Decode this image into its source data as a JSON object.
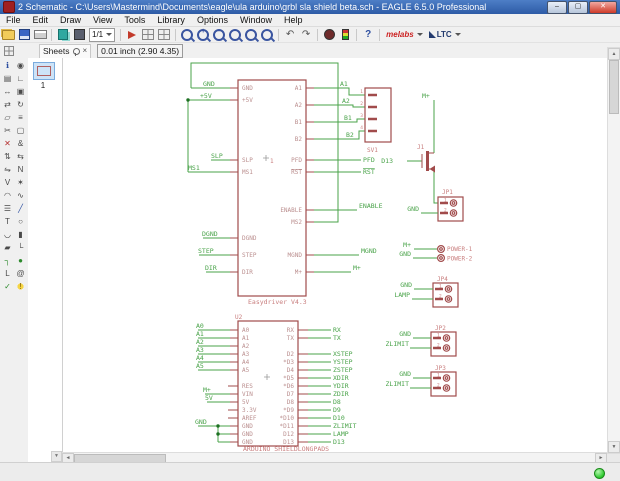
{
  "window": {
    "title": "2 Schematic - C:\\Users\\Mastermind\\Documents\\eagle\\ula arduino\\grbl sla shield beta.sch - EAGLE 6.5.0 Professional"
  },
  "menu": {
    "items": [
      "File",
      "Edit",
      "Draw",
      "View",
      "Tools",
      "Library",
      "Options",
      "Window",
      "Help"
    ]
  },
  "toolbar": {
    "sheet_selector": "1/1",
    "vendor_melabs": "melabs",
    "vendor_ltc": "LTC"
  },
  "param_bar": {
    "sheets_tab": "Sheets",
    "coordinates": "0.01 inch (2.90 4.35)"
  },
  "sheets_panel": {
    "sheet_label": "1"
  },
  "icons": {
    "minimize": "–",
    "maximize": "▢",
    "close": "✕",
    "help": "?",
    "undo": "↶",
    "redo": "↷",
    "zoom_fit": "◻",
    "zoom_in": "+",
    "zoom_out": "–",
    "zoom_redraw": "↻",
    "zoom_select": "▭",
    "zoom_last": "«",
    "tools": {
      "info": "ℹ",
      "show": "◉",
      "display": "▤",
      "mark": "∟",
      "move": "↔",
      "copy": "▣",
      "mirror": "⇄",
      "rotate": "↻",
      "group": "▱",
      "change": "≡",
      "cut": "✂",
      "paste": "▢",
      "delete": "✕",
      "add": "&",
      "pinswap": "⇅",
      "replace": "⇆",
      "gateswap": "⇋",
      "name": "N",
      "value": "V",
      "smash": "✶",
      "miter": "◠",
      "split": "∿",
      "invoke": "☰",
      "wire": "╱",
      "text": "T",
      "circle": "○",
      "arc": "◡",
      "rect": "▮",
      "polygon": "▰",
      "bus": "└",
      "net": "┐",
      "junction": "●",
      "label": "L",
      "attribute": "@",
      "erc": "✓",
      "errors": "!"
    }
  },
  "schematic": {
    "easydriver": {
      "marker": "1",
      "value": "Easydriver V4.3",
      "pins_left": [
        {
          "pin": "GND",
          "net": "GND"
        },
        {
          "pin": "+5V",
          "net": "+5V"
        },
        {
          "pin": "SLP",
          "net": "SLP"
        },
        {
          "pin": "MS1",
          "net": "MS1"
        },
        {
          "pin": "DGND",
          "net": "DGND"
        },
        {
          "pin": "STEP",
          "net": "STEP"
        },
        {
          "pin": "DIR",
          "net": "DIR"
        }
      ],
      "pins_right": [
        {
          "pin": "A1",
          "net": "A1"
        },
        {
          "pin": "A2",
          "net": "A2"
        },
        {
          "pin": "B1",
          "net": "B1"
        },
        {
          "pin": "B2",
          "net": "B2"
        },
        {
          "pin": "PFD",
          "net": "PFD"
        },
        {
          "pin": "RST",
          "net": "RST"
        },
        {
          "pin": "ENABLE",
          "net": "ENABLE"
        },
        {
          "pin": "MS2",
          "net": ""
        },
        {
          "pin": "MGND",
          "net": "MGND"
        },
        {
          "pin": "M+",
          "net": "M+"
        }
      ]
    },
    "sv1": {
      "ref": "SV1",
      "pin_numbers": [
        "1",
        "2",
        "3",
        "4"
      ]
    },
    "mosfet": {
      "ref": "J1",
      "gate_net": "D13",
      "top_net": "M+"
    },
    "jp1": {
      "ref": "JP1",
      "net": "GND",
      "pin_numbers": [
        "1",
        "2"
      ]
    },
    "power": {
      "pin_labels": [
        "POWER-1",
        "POWER-2"
      ],
      "nets": [
        "M+",
        "GND"
      ]
    },
    "jp4": {
      "ref": "JP4",
      "nets": [
        "GND",
        "LAMP"
      ],
      "pin_numbers": [
        "1",
        "2"
      ]
    },
    "jp2": {
      "ref": "JP2",
      "nets": [
        "GND",
        "ZLIMIT"
      ],
      "pin_numbers": [
        "1",
        "2"
      ]
    },
    "jp3": {
      "ref": "JP3",
      "nets": [
        "GND",
        "ZLIMIT"
      ],
      "pin_numbers": [
        "1",
        "2"
      ]
    },
    "arduino": {
      "ref": "U2",
      "value": "ARDUINO_SHIELDLONGPADS",
      "pins_left": [
        {
          "pin": "A0",
          "net": "A0"
        },
        {
          "pin": "A1",
          "net": "A1"
        },
        {
          "pin": "A2",
          "net": "A2"
        },
        {
          "pin": "A3",
          "net": "A3"
        },
        {
          "pin": "A4",
          "net": "A4"
        },
        {
          "pin": "A5",
          "net": "A5"
        },
        {
          "pin": "RES",
          "net": ""
        },
        {
          "pin": "VIN",
          "net": "M+"
        },
        {
          "pin": "5V",
          "net": "5V"
        },
        {
          "pin": "3.3V",
          "net": ""
        },
        {
          "pin": "AREF",
          "net": ""
        },
        {
          "pin": "GND",
          "net": "GND"
        },
        {
          "pin": "GND",
          "net": ""
        },
        {
          "pin": "GND",
          "net": ""
        }
      ],
      "pins_right": [
        {
          "pin": "RX",
          "net": "RX"
        },
        {
          "pin": "TX",
          "net": "TX"
        },
        {
          "pin": "D2",
          "net": "XSTEP"
        },
        {
          "pin": "*D3",
          "net": "YSTEP"
        },
        {
          "pin": "D4",
          "net": "ZSTEP"
        },
        {
          "pin": "*D5",
          "net": "XDIR"
        },
        {
          "pin": "*D6",
          "net": "YDIR"
        },
        {
          "pin": "D7",
          "net": "ZDIR"
        },
        {
          "pin": "D8",
          "net": "D8"
        },
        {
          "pin": "*D9",
          "net": "D9"
        },
        {
          "pin": "*D10",
          "net": "D10"
        },
        {
          "pin": "*D11",
          "net": "ZLIMIT"
        },
        {
          "pin": "D12",
          "net": "LAMP"
        },
        {
          "pin": "D13",
          "net": "D13"
        }
      ]
    }
  }
}
